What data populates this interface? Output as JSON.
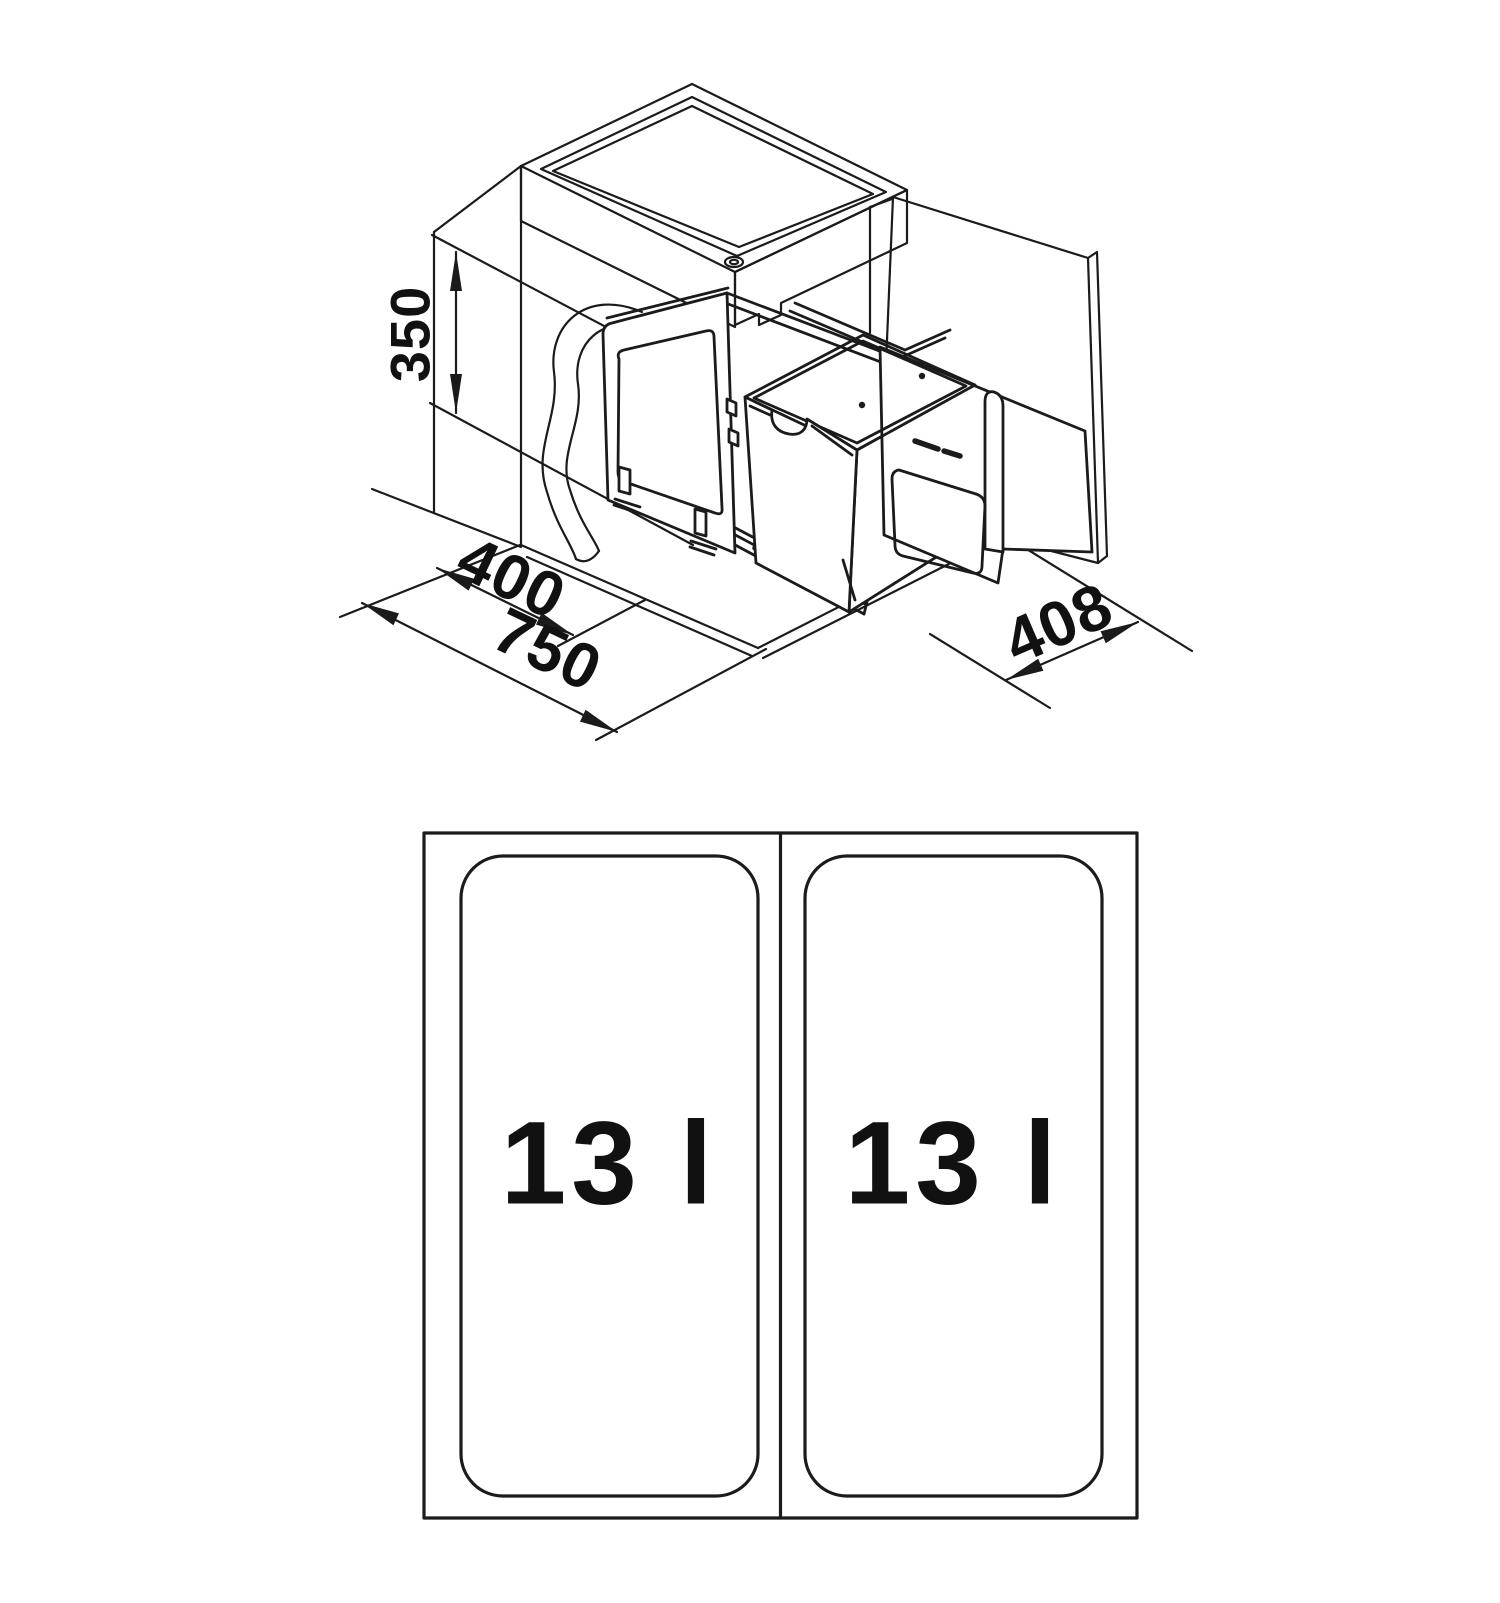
{
  "drawing": {
    "type": "installation-diagram",
    "isometric_view": {
      "dimension_labels": {
        "height": "350",
        "opening_width": "400",
        "cabinet_width": "750",
        "depth": "408"
      }
    },
    "plan_view": {
      "compartments": [
        {
          "capacity": "13 l"
        },
        {
          "capacity": "13 l"
        }
      ]
    },
    "colors": {
      "line": "#1b1b1b",
      "background": "#ffffff"
    }
  }
}
